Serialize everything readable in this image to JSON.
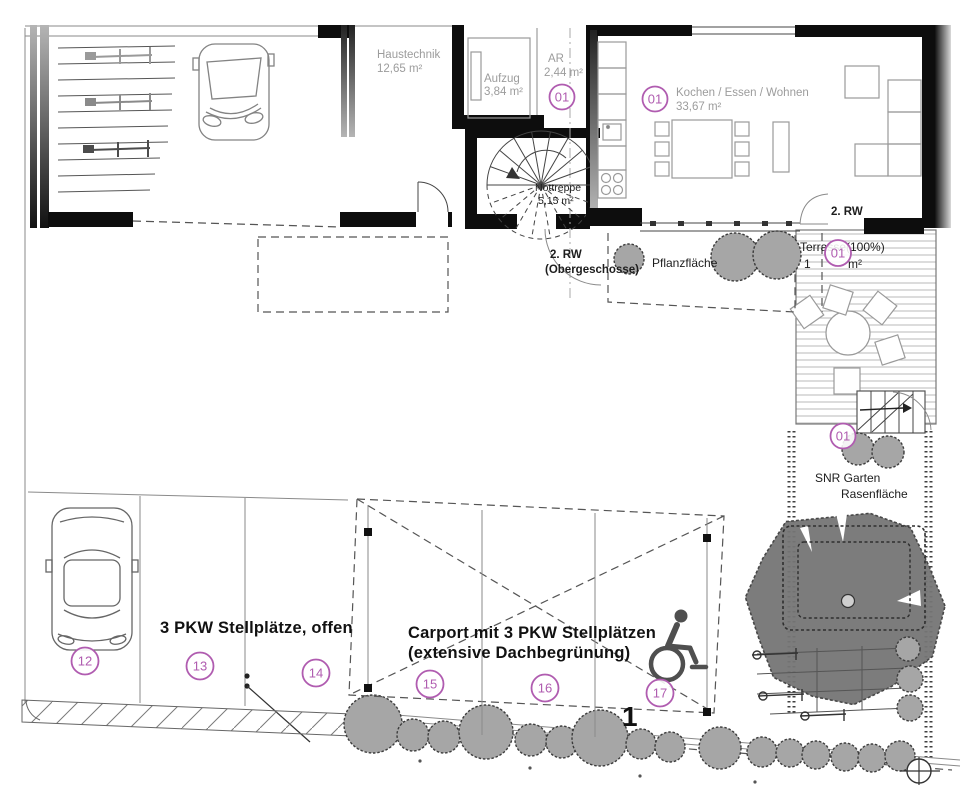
{
  "colors": {
    "badge": "#b05cb0",
    "room_label": "#9c9c9c",
    "ink": "#1d1d1d",
    "bush_fill": "#a6a6a6",
    "tree_fill": "#757575",
    "wall": "#000000"
  },
  "building": {
    "haustechnik": {
      "name": "Haustechnik",
      "area": "12,65 m²"
    },
    "aufzug": {
      "name": "Aufzug",
      "area": "3,84 m²"
    },
    "abstellraum": {
      "name": "AR",
      "area": "2,44 m²",
      "badge": "01"
    },
    "wohnen": {
      "name": "Kochen / Essen / Wohnen",
      "area": "33,67 m²",
      "badge": "01"
    },
    "nottreppe": {
      "name": "Nottreppe",
      "area": "5,15 m²"
    },
    "rw_top": "2. RW",
    "rw_stair_line1": "2. RW",
    "rw_stair_line2": "(Obergeschosse)"
  },
  "outdoor": {
    "terrasse": {
      "line1": "Terrasse(100%)",
      "area_prefix": "1",
      "area_unit": "m²",
      "badge": "01"
    },
    "pflanzflaeche": "Pflanzfläche",
    "garten": {
      "badge": "01",
      "line1": "SNR Garten",
      "line2": "Rasenfläche"
    }
  },
  "parking": {
    "open_label": "3 PKW Stellplätze, offen",
    "carport_line1": "Carport mit 3 PKW Stellplätzen",
    "carport_line2": "(extensive Dachbegrünung)",
    "space_12": "12",
    "space_13": "13",
    "space_14": "14",
    "space_15": "15",
    "space_16": "16",
    "space_17": "17",
    "marker_1": "1"
  }
}
